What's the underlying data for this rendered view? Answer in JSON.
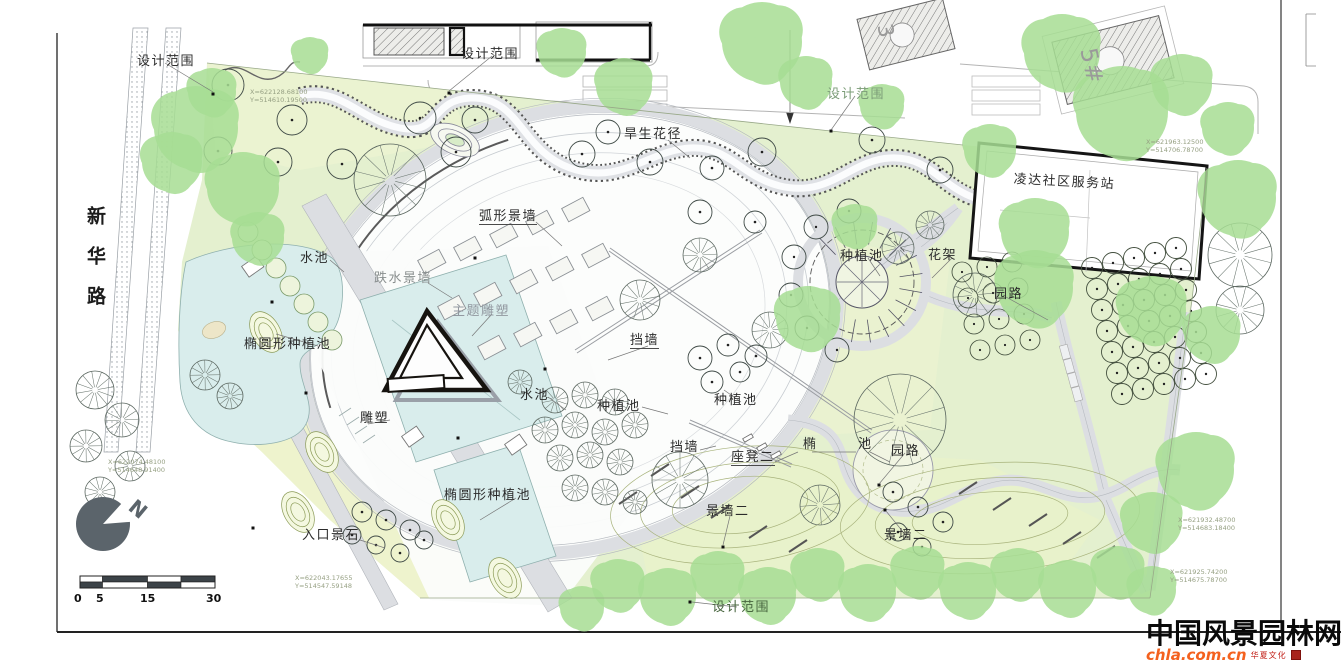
{
  "street": {
    "name": "新华路"
  },
  "annotations": [
    {
      "text": "设计范围",
      "x": 137,
      "y": 55
    },
    {
      "text": "设计范围",
      "x": 461,
      "y": 48
    },
    {
      "text": "设计范围",
      "x": 827,
      "y": 88,
      "color": "#7b9c77"
    },
    {
      "text": "设计范围",
      "x": 712,
      "y": 601,
      "color": "#48663f"
    },
    {
      "text": "旱生花径",
      "x": 624,
      "y": 128
    },
    {
      "text": "弧形景墙",
      "x": 479,
      "y": 210,
      "underline": true
    },
    {
      "text": "水池",
      "x": 300,
      "y": 252
    },
    {
      "text": "跌水景墙",
      "x": 374,
      "y": 272,
      "color": "#8a8f8f"
    },
    {
      "text": "主题雕塑",
      "x": 452,
      "y": 305,
      "color": "#9298a0"
    },
    {
      "text": "椭圆形种植池",
      "x": 244,
      "y": 338
    },
    {
      "text": "雕塑",
      "x": 360,
      "y": 412
    },
    {
      "text": "椭圆形种植池",
      "x": 444,
      "y": 489
    },
    {
      "text": "入口景石",
      "x": 302,
      "y": 529
    },
    {
      "text": "水池",
      "x": 520,
      "y": 389
    },
    {
      "text": "种植池",
      "x": 597,
      "y": 400
    },
    {
      "text": "挡墙",
      "x": 630,
      "y": 334,
      "underline": true
    },
    {
      "text": "种植池",
      "x": 714,
      "y": 394
    },
    {
      "text": "挡墙",
      "x": 670,
      "y": 441
    },
    {
      "text": "座凳二",
      "x": 731,
      "y": 451,
      "underline": true
    },
    {
      "text": "种植池",
      "x": 840,
      "y": 250
    },
    {
      "text": "花架",
      "x": 928,
      "y": 249
    },
    {
      "text": "园路",
      "x": 994,
      "y": 288
    },
    {
      "text": "椭",
      "x": 803,
      "y": 438
    },
    {
      "text": "池",
      "x": 858,
      "y": 438
    },
    {
      "text": "园路",
      "x": 891,
      "y": 445
    },
    {
      "text": "景墙二",
      "x": 706,
      "y": 505
    },
    {
      "text": "景墙二",
      "x": 884,
      "y": 529
    },
    {
      "text": "凌达社区服务站",
      "x": 1014,
      "y": 173,
      "rotate": 3
    },
    {
      "text": "3",
      "x": 894,
      "y": 22,
      "rotate": 78,
      "size": 21,
      "color": "#9a9a9a"
    },
    {
      "text": "5#",
      "x": 1098,
      "y": 46,
      "rotate": 78,
      "size": 23,
      "color": "#9a9a9a"
    },
    {
      "text": "N",
      "x": 138,
      "y": 496,
      "rotate": 40,
      "size": 20,
      "color": "#5b646b",
      "weight": 800
    }
  ],
  "coordinate_callouts": [
    {
      "x_text": "X=622128.68100",
      "y_text": "Y=514610.19500",
      "x": 250,
      "y": 88
    },
    {
      "x_text": "X=622074.48100",
      "y_text": "Y=514648.91400",
      "x": 108,
      "y": 458
    },
    {
      "x_text": "X=622043.17655",
      "y_text": "Y=514547.59148",
      "x": 295,
      "y": 574
    },
    {
      "x_text": "X=621963.12500",
      "y_text": "Y=514706.78700",
      "x": 1146,
      "y": 138
    },
    {
      "x_text": "X=621932.48700",
      "y_text": "Y=514683.18400",
      "x": 1178,
      "y": 516
    },
    {
      "x_text": "X=621925.74200",
      "y_text": "Y=514675.78700",
      "x": 1170,
      "y": 568
    }
  ],
  "scale_bar": {
    "tick_labels": [
      "0",
      "5",
      "15",
      "30"
    ]
  },
  "watermark": {
    "name": "中国风景园林网",
    "url": "chla.com.cn",
    "tagline": "华夏文化",
    "url_color": "#f4611e",
    "tagline_color": "#c22018"
  },
  "colors": {
    "lawn": "#e4f0cf",
    "lawn_light": "#eef4d2",
    "canopy": "#a7de94",
    "water": "#d9edec",
    "path": "#dcdee2",
    "line": "#1c1c1c"
  }
}
